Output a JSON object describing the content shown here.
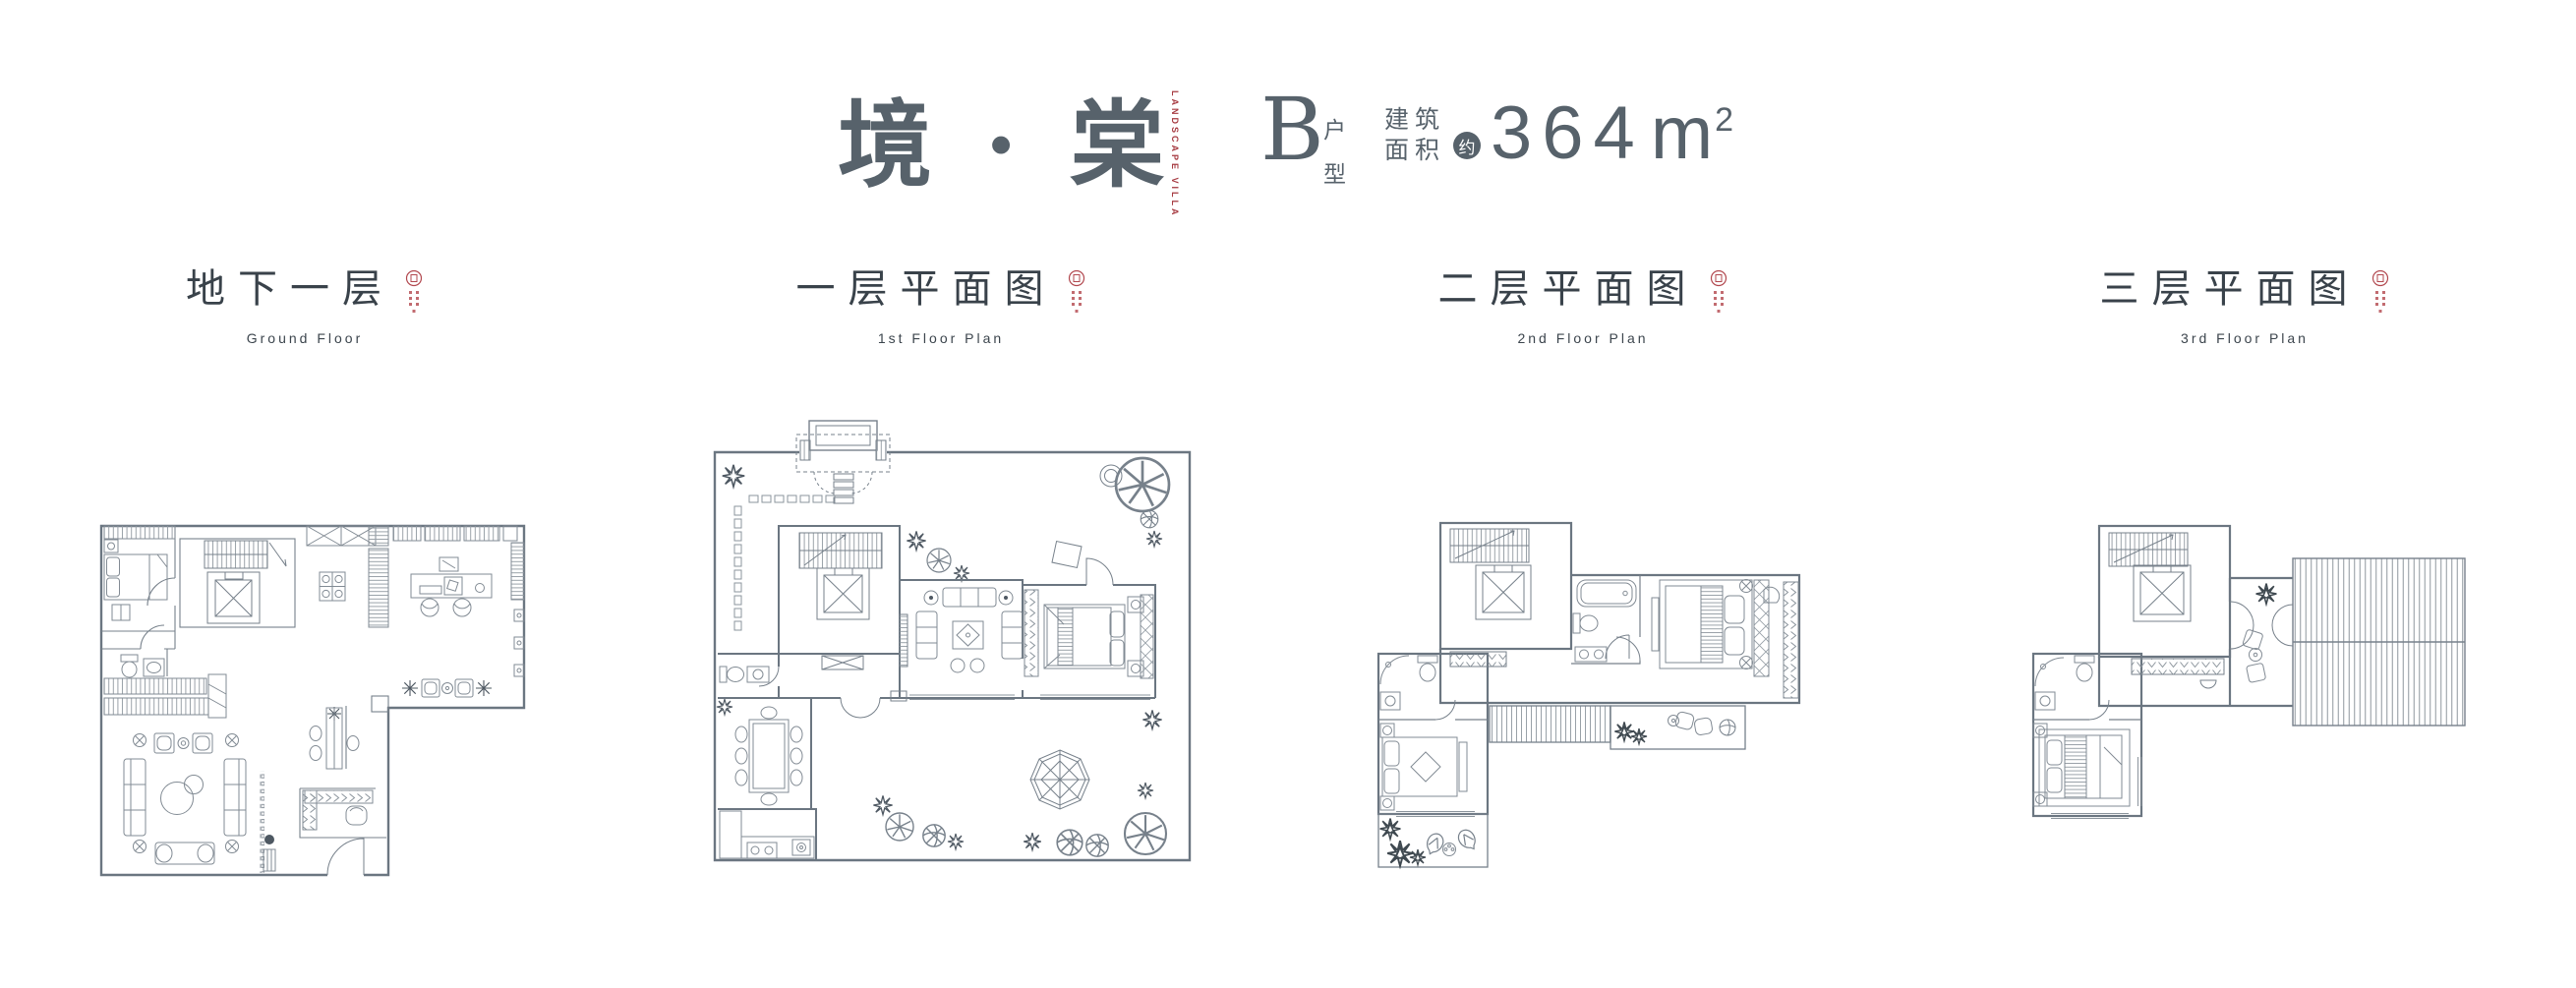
{
  "header": {
    "project_title": "境 · 棠",
    "logo_vertical_line1": "LANDSCAPE",
    "logo_vertical_line2": "VILLA",
    "unit_letter": "B",
    "unit_suffix_top": "户",
    "unit_suffix_bottom": "型",
    "area_label_row1": "建筑",
    "area_label_row2": "面积",
    "area_approx": "约",
    "area_value": "364",
    "area_unit": "m",
    "area_exponent": "2"
  },
  "colors": {
    "accent_text": "#57626b",
    "logo_red": "#a63a41",
    "label_text": "#39424a",
    "plan_line": "#77818b",
    "plan_wall": "#6b7681",
    "background": "#ffffff"
  },
  "floor_plans": [
    {
      "title_cn": "地下一层",
      "title_en": "Ground Floor"
    },
    {
      "title_cn": "一层平面图",
      "title_en": "1st Floor Plan"
    },
    {
      "title_cn": "二层平面图",
      "title_en": "2nd Floor Plan"
    },
    {
      "title_cn": "三层平面图",
      "title_en": "3rd Floor Plan"
    }
  ]
}
